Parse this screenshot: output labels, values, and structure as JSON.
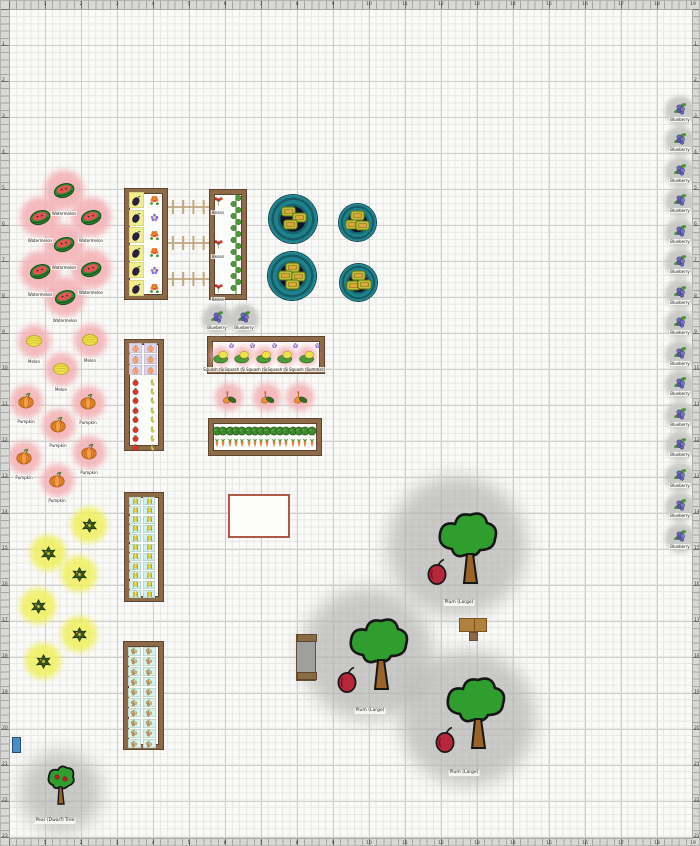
{
  "scene": {
    "width": 700,
    "height": 846
  },
  "rulers": {
    "unit_top": [
      "1",
      "2",
      "3",
      "4",
      "5",
      "6",
      "7",
      "8",
      "9",
      "10",
      "11",
      "12",
      "13",
      "14",
      "15",
      "16",
      "17",
      "18",
      "19"
    ],
    "unit_left": [
      "1",
      "2",
      "3",
      "4",
      "5",
      "6",
      "7",
      "8",
      "9",
      "10",
      "11",
      "12",
      "13",
      "14",
      "15",
      "16",
      "17",
      "18",
      "19",
      "20",
      "21",
      "22",
      "23"
    ]
  },
  "colors": {
    "halo_pink": "#f4b0b4",
    "halo_yellow": "#f0f05c",
    "canopy_shadow": "#b2b2b0",
    "bed_wood": "#8d6b49",
    "planter_teal": "#1e828c",
    "outline_red": "#b2594a",
    "bin_blue": "#4a8ec8",
    "grid_minor": "#e7e7e5",
    "grid_major": "#cfcfcd",
    "ruler_bg": "#d8d8d6",
    "paper": "#fafaf8"
  },
  "patches": [
    {
      "name": "watermelon",
      "icon": "watermelon",
      "label": "Watermelon",
      "halo": "#f4b0b4",
      "d": 40,
      "icon_size": 22,
      "pts": [
        [
          63,
          189
        ],
        [
          39,
          216
        ],
        [
          90,
          216
        ],
        [
          63,
          243
        ],
        [
          90,
          268
        ],
        [
          39,
          270
        ],
        [
          64,
          296
        ]
      ]
    },
    {
      "name": "melon",
      "icon": "melon",
      "label": "Melon",
      "halo": "#f4b0b4",
      "d": 33,
      "icon_size": 18,
      "pts": [
        [
          33,
          340
        ],
        [
          89,
          339
        ],
        [
          60,
          368
        ]
      ]
    },
    {
      "name": "pumpkin",
      "icon": "pumpkin",
      "label": "Pumpkin",
      "halo": "#f4b0b4",
      "d": 33,
      "icon_size": 18,
      "pts": [
        [
          25,
          400
        ],
        [
          87,
          401
        ],
        [
          57,
          424
        ],
        [
          88,
          451
        ],
        [
          23,
          456
        ],
        [
          56,
          479
        ]
      ]
    },
    {
      "name": "winter-squash",
      "icon": "squash_dark",
      "label": "",
      "halo": "#f0f05c",
      "d": 36,
      "icon_size": 17,
      "pts": [
        [
          88,
          524
        ],
        [
          47,
          552
        ],
        [
          78,
          573
        ],
        [
          37,
          605
        ],
        [
          78,
          633
        ],
        [
          42,
          660
        ]
      ]
    },
    {
      "name": "gourds",
      "icon": "gourds",
      "label": "",
      "halo": "#f4b0b4",
      "d": 28,
      "icon_size": 16,
      "pts": [
        [
          228,
          396
        ],
        [
          266,
          396
        ],
        [
          299,
          396
        ]
      ]
    }
  ],
  "blueberries": {
    "label": "Blueberry",
    "d": 30,
    "icon_size": 15,
    "pts": [
      [
        216,
        318
      ],
      [
        243,
        318
      ],
      [
        679,
        110
      ],
      [
        679,
        140
      ],
      [
        679,
        171
      ],
      [
        679,
        201
      ],
      [
        679,
        232
      ],
      [
        679,
        262
      ],
      [
        679,
        293
      ],
      [
        679,
        323
      ],
      [
        679,
        354
      ],
      [
        679,
        384
      ],
      [
        679,
        415
      ],
      [
        679,
        445
      ],
      [
        679,
        476
      ],
      [
        679,
        506
      ],
      [
        679,
        537
      ]
    ]
  },
  "beds": [
    {
      "name": "bed-eggplant-flowers",
      "rect": [
        124,
        188,
        42,
        110
      ],
      "grids": [
        {
          "icon": "eggplant",
          "x0": 135,
          "y0": 199,
          "dx": 0,
          "dy": 17.6,
          "cols": 1,
          "rows": 6,
          "cell": [
            15,
            16,
            "#f1ee8f"
          ],
          "size": 13
        },
        {
          "icon": "marigold",
          "types": [
            "marigold",
            "lavender",
            "marigold",
            "marigold",
            "lavender",
            "marigold"
          ],
          "x0": 153,
          "y0": 199,
          "dy": 17.6,
          "rows": 6,
          "cols": 1,
          "size": 13
        }
      ]
    },
    {
      "name": "bed-beans-cucumber",
      "rect": [
        209,
        189,
        36,
        109
      ],
      "grids": [
        {
          "icon": "beans",
          "x0": 217,
          "y0": 200,
          "dy": 43.5,
          "rows": 3,
          "cols": 1,
          "size": 13,
          "label": "Beans",
          "label_dy": 9
        }
      ]
    },
    {
      "name": "bed-squash-melons",
      "rect": [
        207,
        336,
        116,
        36
      ],
      "grids": [
        {
          "icon": "melon_plant",
          "x0": 220,
          "y0": 355,
          "dx": 21.5,
          "cols": 5,
          "rows": 1,
          "size": 17,
          "halo": "#f4b0b4",
          "halo_d": 20,
          "label": "Squash (Summer)",
          "label_dy": 11
        },
        {
          "icon": "lavender",
          "x0": 230,
          "y0": 344,
          "dx": 21.5,
          "cols": 5,
          "rows": 1,
          "size": 9
        }
      ]
    },
    {
      "name": "bed-peach-tomato-pepper",
      "rect": [
        124,
        339,
        38,
        110
      ],
      "grids": [
        {
          "icon": "peach",
          "x0": 134,
          "y0": 347,
          "dx": 15,
          "dy": 11,
          "cols": 2,
          "rows": 3,
          "cell": [
            13,
            10,
            "#dcd5f2"
          ],
          "size": 9
        },
        {
          "icon": "tomato",
          "x0": 134,
          "y0": 381,
          "dy": 9.4,
          "rows": 8,
          "cols": 1,
          "size": 9
        },
        {
          "icon": "pepper",
          "x0": 151,
          "y0": 381,
          "dy": 9.4,
          "rows": 8,
          "cols": 1,
          "size": 9
        }
      ]
    },
    {
      "name": "bed-carrots",
      "rect": [
        208,
        418,
        112,
        36
      ],
      "grids": [
        {
          "icon": "hedge",
          "x0": 216,
          "y0": 430,
          "dx": 6.3,
          "cols": 16,
          "rows": 1,
          "size": 10
        },
        {
          "icon": "carrot",
          "x0": 216,
          "y0": 442,
          "dx": 6.3,
          "cols": 16,
          "rows": 1,
          "size": 10
        }
      ]
    },
    {
      "name": "bed-corn",
      "rect": [
        124,
        492,
        38,
        108
      ],
      "grids": [
        {
          "icon": "corn",
          "x0": 134,
          "y0": 500,
          "dx": 14,
          "dy": 9.3,
          "cols": 2,
          "rows": 11,
          "cell": [
            12,
            8,
            "#cff2ef"
          ],
          "size": 9
        }
      ]
    },
    {
      "name": "bed-peanuts",
      "rect": [
        123,
        641,
        39,
        107
      ],
      "grids": [
        {
          "icon": "peanut",
          "x0": 133,
          "y0": 650,
          "dx": 15,
          "dy": 10.3,
          "cols": 2,
          "rows": 10,
          "cell": [
            13,
            9,
            "#d8f2ee"
          ],
          "size": 10
        }
      ]
    }
  ],
  "vine": {
    "x": 229,
    "y": 193,
    "h": 100
  },
  "trellises": [
    {
      "x": 167,
      "y": 206,
      "w": 41
    },
    {
      "x": 167,
      "y": 242,
      "w": 41
    },
    {
      "x": 167,
      "y": 278,
      "w": 41
    }
  ],
  "planters": [
    {
      "x": 292,
      "y": 218,
      "d": 48,
      "squash": [
        [
          -5,
          -8
        ],
        [
          6,
          -2
        ],
        [
          -3,
          5
        ]
      ]
    },
    {
      "x": 356,
      "y": 221,
      "d": 37,
      "squash": [
        [
          0,
          -7
        ],
        [
          -5,
          2
        ],
        [
          5,
          3
        ]
      ]
    },
    {
      "x": 291,
      "y": 275,
      "d": 48,
      "squash": [
        [
          0,
          -9
        ],
        [
          -7,
          -1
        ],
        [
          6,
          0
        ],
        [
          0,
          8
        ]
      ]
    },
    {
      "x": 357,
      "y": 281,
      "d": 37,
      "squash": [
        [
          0,
          -7
        ],
        [
          -5,
          3
        ],
        [
          6,
          2
        ]
      ]
    }
  ],
  "trees": [
    {
      "label": "Plum (Large)",
      "cx": 456,
      "cy": 545,
      "r": 70,
      "tx": 433,
      "ty": 508,
      "fx": 425,
      "fy": 556,
      "lx": 458,
      "ly": 599
    },
    {
      "label": "Plum (Large)",
      "cx": 366,
      "cy": 653,
      "r": 66,
      "tx": 344,
      "ty": 614,
      "fx": 335,
      "fy": 664,
      "lx": 369,
      "ly": 707
    },
    {
      "label": "Plum (Large)",
      "cx": 467,
      "cy": 717,
      "r": 68,
      "tx": 441,
      "ty": 673,
      "fx": 433,
      "fy": 724,
      "lx": 463,
      "ly": 769
    }
  ],
  "dwarf_tree": {
    "label": "Pear (Dwarf) Tree",
    "cx": 60,
    "cy": 791,
    "r": 41,
    "tx": 44,
    "ty": 763,
    "lx": 54,
    "ly": 817
  },
  "structures": {
    "red_outline": [
      227,
      493,
      62,
      44
    ],
    "bench": [
      295,
      633,
      20,
      47
    ],
    "wood_panels": [
      458,
      617,
      28,
      14
    ],
    "wood_leg": [
      468,
      631,
      9,
      9
    ],
    "blue_bin": [
      11,
      736,
      9,
      16
    ]
  }
}
